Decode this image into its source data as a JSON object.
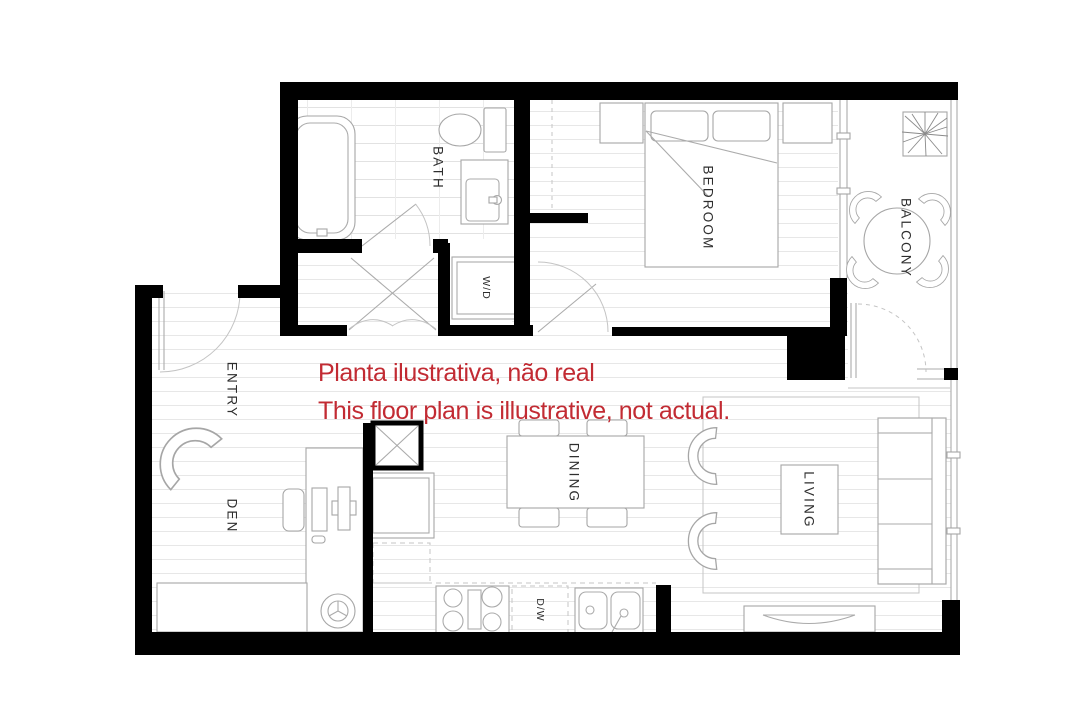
{
  "disclaimer": {
    "line1": "Planta ilustrativa, não real",
    "line2": "This floor plan is illustrative, not actual.",
    "color": "#c22b33"
  },
  "rooms": {
    "bath": {
      "label": "BATH"
    },
    "bedroom": {
      "label": "BEDROOM"
    },
    "balcony": {
      "label": "BALCONY"
    },
    "entry": {
      "label": "ENTRY"
    },
    "den": {
      "label": "DEN"
    },
    "dining": {
      "label": "DINING"
    },
    "living": {
      "label": "LIVING"
    },
    "washer_dryer": {
      "label": "W/D"
    },
    "dishwasher": {
      "label": "D/W"
    }
  },
  "colors": {
    "wall": "#000000",
    "label": "#2e2e2e",
    "furniture_line": "#a6a6a6",
    "floor_line": "#e7e7e7",
    "background": "#ffffff"
  }
}
